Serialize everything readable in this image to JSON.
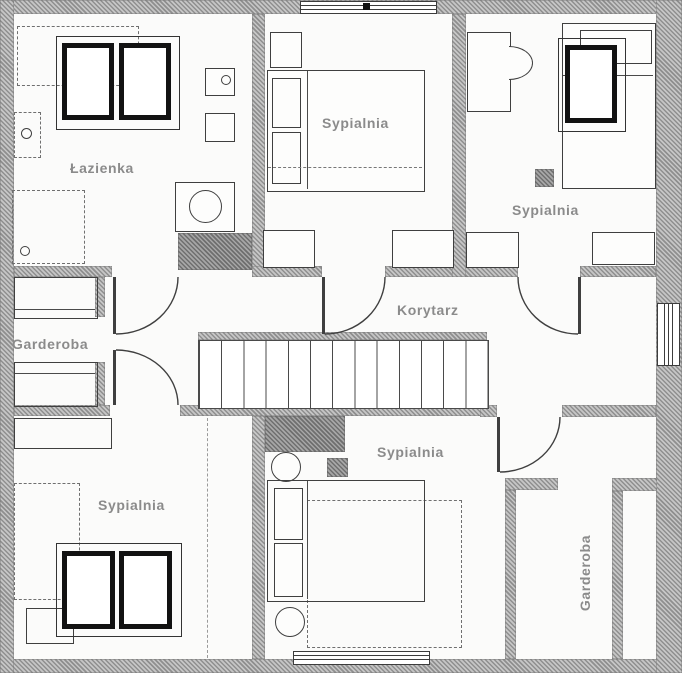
{
  "floorplan": {
    "type": "architectural-floor-plan",
    "storey": "attic",
    "rooms": {
      "lazienka": {
        "label": "Łazienka",
        "furniture": [
          "bathtub",
          "roof-window-double",
          "sink",
          "shower",
          "toilet",
          "cabinet",
          "washing-machine",
          "chimney"
        ]
      },
      "sypialnia_top_middle": {
        "label": "Sypialnia",
        "furniture": [
          "nightstand",
          "double-bed",
          "radiator",
          "radiator",
          "window"
        ]
      },
      "sypialnia_top_right": {
        "label": "Sypialnia",
        "furniture": [
          "desk",
          "chair",
          "single-bed",
          "roof-window-single",
          "vent-square",
          "radiator",
          "radiator"
        ]
      },
      "korytarz": {
        "label": "Korytarz",
        "furniture": [
          "staircase"
        ]
      },
      "garderoba_left": {
        "label": "Garderoba",
        "furniture": [
          "closet-rail",
          "closet-rail"
        ]
      },
      "sypialnia_bottom_left": {
        "label": "Sypialnia",
        "furniture": [
          "wardrobe",
          "single-bed",
          "bench",
          "roof-window-double"
        ]
      },
      "sypialnia_bottom_middle": {
        "label": "Sypialnia",
        "furniture": [
          "chimney",
          "stool",
          "vent-square",
          "double-bed",
          "stool",
          "window"
        ]
      },
      "garderoba_right": {
        "label": "Garderoba",
        "furniture": [
          "closet-partition",
          "closet-partition"
        ]
      }
    },
    "stairs": {
      "steps": 13
    },
    "colors": {
      "wall_hatch_dark": "#8f8f8f",
      "wall_hatch_light": "#c6c6c6",
      "chimney_hatch": "#6f6f6f",
      "line": "#3f3f3f",
      "label_text": "#8b8b8b",
      "background": "#fbfbfa",
      "roof_window_frame": "#121212"
    }
  }
}
